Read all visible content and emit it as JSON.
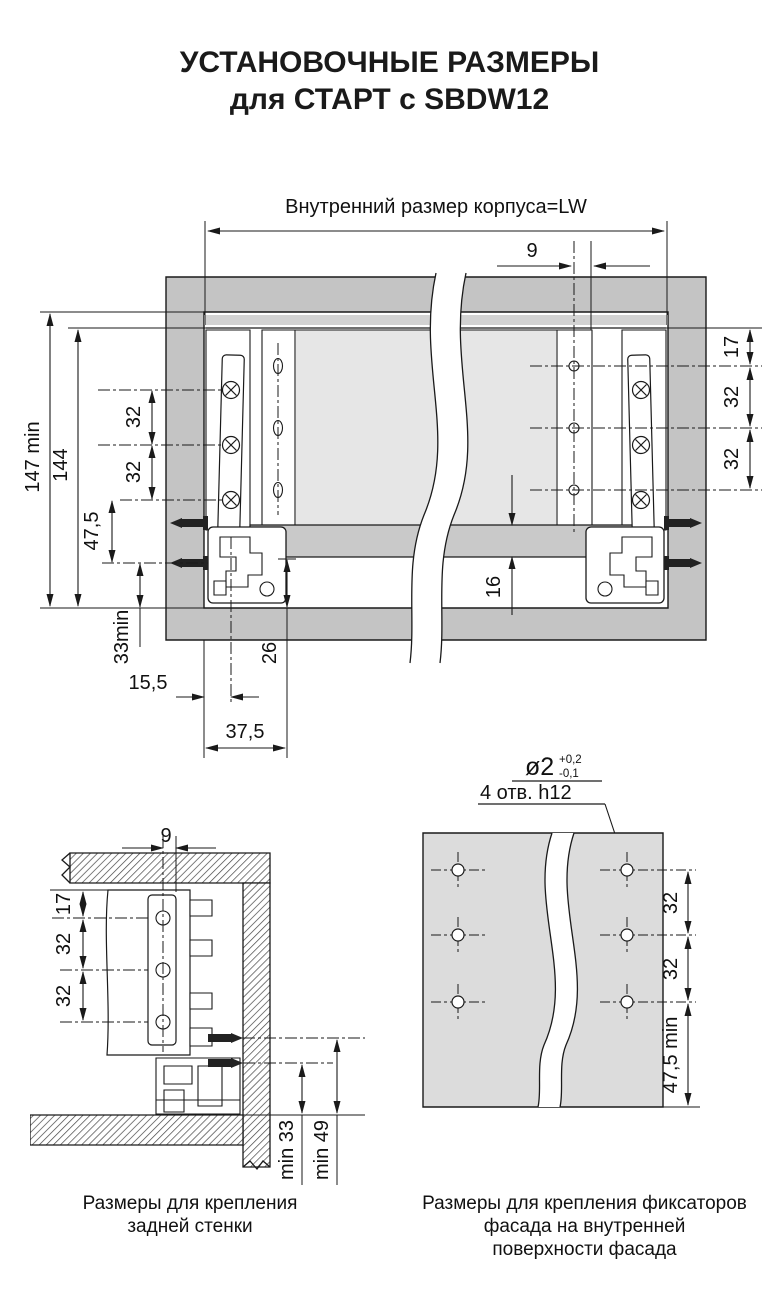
{
  "title": {
    "line1": "УСТАНОВОЧНЫЕ РАЗМЕРЫ",
    "line2": "для СТАРТ с SBDW12"
  },
  "main": {
    "top_label": "Внутренний размер корпуса=LW",
    "dim_9": "9",
    "dim_147": "147 min",
    "dim_144": "144",
    "dim_32_left_1": "32",
    "dim_32_left_2": "32",
    "dim_47_5": "47,5",
    "dim_33min": "33min",
    "dim_15_5": "15,5",
    "dim_37_5": "37,5",
    "dim_26": "26",
    "dim_16": "16",
    "dim_17": "17",
    "dim_32_right_1": "32",
    "dim_32_right_2": "32"
  },
  "back_wall": {
    "dim_9": "9",
    "dim_17": "17",
    "dim_32_1": "32",
    "dim_32_2": "32",
    "dim_min33": "min 33",
    "dim_min49": "min 49",
    "caption_line1": "Размеры для крепления",
    "caption_line2": "задней стенки"
  },
  "facade": {
    "hole_dia": "ø2",
    "tol_plus": "+0,2",
    "tol_minus": "-0,1",
    "hole_note": "4 отв. h12",
    "dim_32_1": "32",
    "dim_32_2": "32",
    "dim_47_5min": "47,5 min",
    "caption_line1": "Размеры для крепления фиксаторов",
    "caption_line2": "фасада на внутренней",
    "caption_line3": "поверхности фасада"
  },
  "colors": {
    "cabinet_gray": "#c4c4c4",
    "drawer_bottom_gray": "#e6e6e6",
    "back_panel_gray": "#c9c9c9",
    "facade_panel_gray": "#dcdcdc",
    "line": "#1a1a1a"
  }
}
